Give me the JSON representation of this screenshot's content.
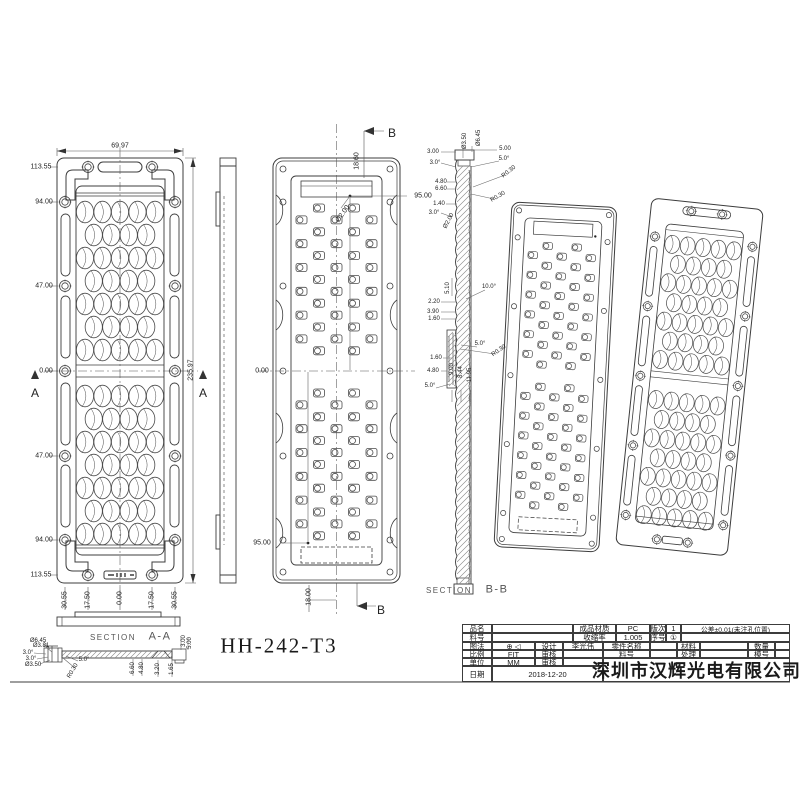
{
  "sheet": {
    "part_number": "HH-242-T3",
    "company": "深圳市汉辉光电有限公司",
    "annotations": [
      {
        "t": "69.97",
        "x": 120,
        "y": 146
      },
      {
        "t": "113.55",
        "x": 41,
        "y": 167
      },
      {
        "t": "94.00",
        "x": 44,
        "y": 202
      },
      {
        "t": "47.00",
        "x": 44,
        "y": 286
      },
      {
        "t": "0.00",
        "x": 46,
        "y": 371
      },
      {
        "t": "47.00",
        "x": 44,
        "y": 456
      },
      {
        "t": "94.00",
        "x": 44,
        "y": 540
      },
      {
        "t": "113.55",
        "x": 41,
        "y": 575
      },
      {
        "t": "235.97",
        "x": 191,
        "y": 370,
        "r": -90
      },
      {
        "t": "30.55",
        "x": 65,
        "y": 600,
        "r": -90
      },
      {
        "t": "17.50",
        "x": 88,
        "y": 600,
        "r": -90
      },
      {
        "t": "0.00",
        "x": 120,
        "y": 598,
        "r": -90
      },
      {
        "t": "17.50",
        "x": 152,
        "y": 600,
        "r": -90
      },
      {
        "t": "30.55",
        "x": 175,
        "y": 600,
        "r": -90
      },
      {
        "t": "A",
        "x": 35,
        "y": 393,
        "s": 12,
        "n": "section-arrow-label"
      },
      {
        "t": "A",
        "x": 203,
        "y": 393,
        "s": 12,
        "n": "section-arrow-label"
      },
      {
        "t": "B",
        "x": 392,
        "y": 133,
        "s": 12,
        "n": "section-arrow-label"
      },
      {
        "t": "18.60",
        "x": 357,
        "y": 161,
        "r": -90
      },
      {
        "t": "95.00",
        "x": 423,
        "y": 196
      },
      {
        "t": "Ø2.00",
        "x": 343,
        "y": 214,
        "r": -55
      },
      {
        "t": "0.00",
        "x": 262,
        "y": 371
      },
      {
        "t": "95.00",
        "x": 262,
        "y": 543
      },
      {
        "t": "18.00",
        "x": 309,
        "y": 597,
        "r": -90
      },
      {
        "t": "B",
        "x": 381,
        "y": 610,
        "s": 12,
        "n": "section-arrow-label"
      },
      {
        "t": "Ø3.50",
        "x": 465,
        "y": 141,
        "r": -90,
        "s": 6
      },
      {
        "t": "Ø6.45",
        "x": 479,
        "y": 138,
        "r": -90,
        "s": 6
      },
      {
        "t": "3.00",
        "x": 433,
        "y": 152,
        "s": 6
      },
      {
        "t": "5.00",
        "x": 505,
        "y": 149,
        "s": 6
      },
      {
        "t": "3.0°",
        "x": 435,
        "y": 163,
        "s": 6
      },
      {
        "t": "5.0°",
        "x": 504,
        "y": 159,
        "s": 6
      },
      {
        "t": "R0.30",
        "x": 509,
        "y": 172,
        "r": -38,
        "s": 6
      },
      {
        "t": "4.80",
        "x": 441,
        "y": 182,
        "s": 6
      },
      {
        "t": "6.60",
        "x": 441,
        "y": 189,
        "s": 6
      },
      {
        "t": "R0.30",
        "x": 498,
        "y": 197,
        "r": -30,
        "s": 6
      },
      {
        "t": "1.40",
        "x": 439,
        "y": 204,
        "s": 6
      },
      {
        "t": "3.0°",
        "x": 434,
        "y": 213,
        "s": 6
      },
      {
        "t": "Ø2.00",
        "x": 449,
        "y": 221,
        "r": -62,
        "s": 6
      },
      {
        "t": "5.10",
        "x": 448,
        "y": 288,
        "r": -90,
        "s": 6
      },
      {
        "t": "10.0°",
        "x": 489,
        "y": 287,
        "s": 6
      },
      {
        "t": "2.20",
        "x": 434,
        "y": 302,
        "s": 6
      },
      {
        "t": "3.90",
        "x": 433,
        "y": 312,
        "s": 6
      },
      {
        "t": "1.60",
        "x": 434,
        "y": 319,
        "s": 6
      },
      {
        "t": "5.0°",
        "x": 480,
        "y": 344,
        "s": 6
      },
      {
        "t": "R0.30",
        "x": 499,
        "y": 351,
        "r": -35,
        "s": 6
      },
      {
        "t": "1.60",
        "x": 436,
        "y": 358,
        "s": 6
      },
      {
        "t": "4.80",
        "x": 433,
        "y": 371,
        "s": 6
      },
      {
        "t": "9.00",
        "x": 452,
        "y": 369,
        "r": -90,
        "s": 6
      },
      {
        "t": "8.44",
        "x": 461,
        "y": 372,
        "r": -90,
        "s": 6
      },
      {
        "t": "11.95",
        "x": 470,
        "y": 375,
        "r": -90,
        "s": 6
      },
      {
        "t": "5.0°",
        "x": 430,
        "y": 386,
        "s": 6
      },
      {
        "t": "SECTION",
        "x": 449,
        "y": 591,
        "s": 8,
        "c": "sec",
        "n": "section-caption"
      },
      {
        "t": "B-B",
        "x": 497,
        "y": 590,
        "s": 11,
        "c": "sec",
        "n": "section-caption"
      },
      {
        "t": "SECTION",
        "x": 113,
        "y": 638,
        "s": 8,
        "c": "sec",
        "n": "section-caption"
      },
      {
        "t": "A-A",
        "x": 160,
        "y": 637,
        "s": 11,
        "c": "sec",
        "n": "section-caption"
      },
      {
        "t": "Ø6.45",
        "x": 38,
        "y": 641,
        "s": 6
      },
      {
        "t": "Ø3.81",
        "x": 41,
        "y": 646,
        "s": 6
      },
      {
        "t": "3.0°",
        "x": 28,
        "y": 653,
        "s": 6
      },
      {
        "t": "3.0°",
        "x": 31,
        "y": 659,
        "s": 6
      },
      {
        "t": "Ø3.50",
        "x": 33,
        "y": 665,
        "s": 6
      },
      {
        "t": "5.0°",
        "x": 84,
        "y": 660,
        "s": 6
      },
      {
        "t": "R0.30",
        "x": 73,
        "y": 671,
        "r": -60,
        "s": 6
      },
      {
        "t": "6.60",
        "x": 133,
        "y": 668,
        "r": -90,
        "s": 6
      },
      {
        "t": "4.80",
        "x": 142,
        "y": 668,
        "r": -90,
        "s": 6
      },
      {
        "t": "3.20",
        "x": 158,
        "y": 669,
        "r": -90,
        "s": 6
      },
      {
        "t": "1.65",
        "x": 172,
        "y": 669,
        "r": -90,
        "s": 6
      },
      {
        "t": "3.00",
        "x": 184,
        "y": 641,
        "r": -90,
        "s": 6
      },
      {
        "t": "5.00",
        "x": 190,
        "y": 643,
        "r": -90,
        "s": 6
      },
      {
        "t": "HH-242-T3",
        "x": 279,
        "y": 646,
        "s": 21,
        "c": "pn",
        "n": "part-number"
      }
    ],
    "title_block": {
      "cells": [
        {
          "t": "品名",
          "x": 462,
          "y": 624,
          "w": 30,
          "h": 9
        },
        {
          "t": "",
          "x": 492,
          "y": 624,
          "w": 81,
          "h": 9
        },
        {
          "t": "成品材质",
          "x": 573,
          "y": 624,
          "w": 43,
          "h": 9
        },
        {
          "t": "PC",
          "x": 616,
          "y": 624,
          "w": 34,
          "h": 9
        },
        {
          "t": "版次",
          "x": 650,
          "y": 624,
          "w": 16,
          "h": 9
        },
        {
          "t": "1",
          "x": 666,
          "y": 624,
          "w": 15,
          "h": 9
        },
        {
          "t": "公差±0.01(未注孔位置)",
          "x": 681,
          "y": 624,
          "w": 109,
          "h": 9,
          "cls": "small"
        },
        {
          "t": "料号",
          "x": 462,
          "y": 633,
          "w": 30,
          "h": 9
        },
        {
          "t": "",
          "x": 492,
          "y": 633,
          "w": 81,
          "h": 9
        },
        {
          "t": "收缩率",
          "x": 573,
          "y": 633,
          "w": 43,
          "h": 9
        },
        {
          "t": "1.005",
          "x": 616,
          "y": 633,
          "w": 34,
          "h": 9
        },
        {
          "t": "序号",
          "x": 650,
          "y": 633,
          "w": 16,
          "h": 9
        },
        {
          "t": "①",
          "x": 666,
          "y": 633,
          "w": 15,
          "h": 9
        },
        {
          "t": "",
          "x": 681,
          "y": 633,
          "w": 109,
          "h": 9
        },
        {
          "t": "图法",
          "x": 462,
          "y": 642,
          "w": 30,
          "h": 8
        },
        {
          "t": "⊕ ◁",
          "x": 492,
          "y": 642,
          "w": 43,
          "h": 8
        },
        {
          "t": "设计",
          "x": 535,
          "y": 642,
          "w": 28,
          "h": 8
        },
        {
          "t": "李光伟",
          "x": 563,
          "y": 642,
          "w": 40,
          "h": 8
        },
        {
          "t": "零件名称",
          "x": 603,
          "y": 642,
          "w": 47,
          "h": 8
        },
        {
          "t": "",
          "x": 650,
          "y": 642,
          "w": 27,
          "h": 8
        },
        {
          "t": "材料",
          "x": 677,
          "y": 642,
          "w": 23,
          "h": 8
        },
        {
          "t": "",
          "x": 700,
          "y": 642,
          "w": 48,
          "h": 8
        },
        {
          "t": "数量",
          "x": 748,
          "y": 642,
          "w": 27,
          "h": 8
        },
        {
          "t": "",
          "x": 775,
          "y": 642,
          "w": 15,
          "h": 8
        },
        {
          "t": "比例",
          "x": 462,
          "y": 650,
          "w": 30,
          "h": 8
        },
        {
          "t": "FIT",
          "x": 492,
          "y": 650,
          "w": 43,
          "h": 8
        },
        {
          "t": "审核",
          "x": 535,
          "y": 650,
          "w": 28,
          "h": 8
        },
        {
          "t": "",
          "x": 563,
          "y": 650,
          "w": 40,
          "h": 8
        },
        {
          "t": "料号",
          "x": 603,
          "y": 650,
          "w": 47,
          "h": 8
        },
        {
          "t": "",
          "x": 650,
          "y": 650,
          "w": 27,
          "h": 8
        },
        {
          "t": "处理",
          "x": 677,
          "y": 650,
          "w": 23,
          "h": 8
        },
        {
          "t": "",
          "x": 700,
          "y": 650,
          "w": 48,
          "h": 8
        },
        {
          "t": "模号",
          "x": 748,
          "y": 650,
          "w": 27,
          "h": 8
        },
        {
          "t": "",
          "x": 775,
          "y": 650,
          "w": 15,
          "h": 8
        },
        {
          "t": "单位",
          "x": 462,
          "y": 658,
          "w": 30,
          "h": 8
        },
        {
          "t": "MM",
          "x": 492,
          "y": 658,
          "w": 43,
          "h": 8
        },
        {
          "t": "审核",
          "x": 535,
          "y": 658,
          "w": 28,
          "h": 8
        },
        {
          "t": "",
          "x": 563,
          "y": 658,
          "w": 40,
          "h": 8
        },
        {
          "t": "日期",
          "x": 462,
          "y": 666,
          "w": 30,
          "h": 16
        },
        {
          "t": "2018-12-20",
          "x": 492,
          "y": 666,
          "w": 111,
          "h": 16
        },
        {
          "t": "深圳市汉辉光电有限公司",
          "x": 603,
          "y": 658,
          "w": 187,
          "h": 24,
          "cls": "company"
        }
      ]
    }
  }
}
